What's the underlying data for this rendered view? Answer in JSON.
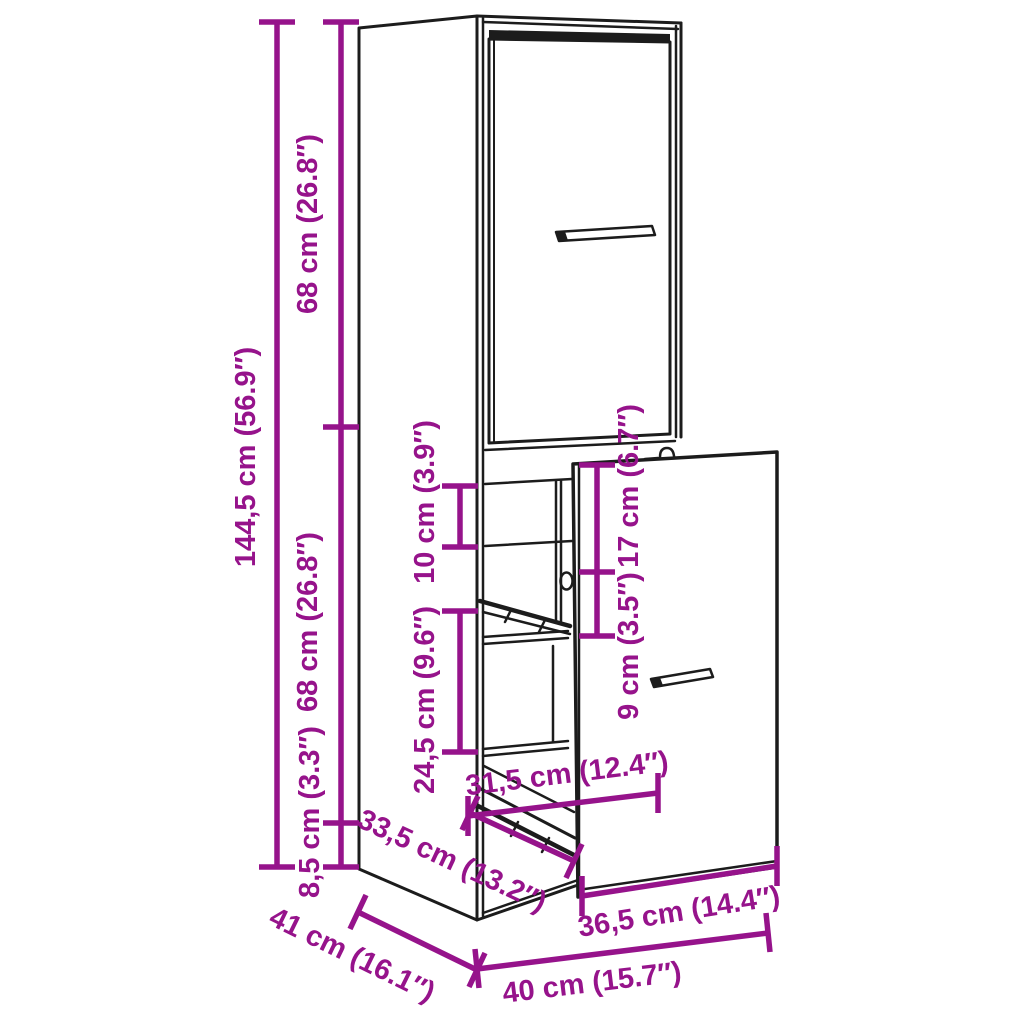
{
  "figure": {
    "title": "apothecary-cabinet-dimension-diagram",
    "colors": {
      "dimension_accent": "#96138b",
      "line_art": "#1c1c1c",
      "background": "#ffffff"
    }
  },
  "dims": {
    "total_height": "144,5 cm (56.9″)",
    "upper_section_height": "68 cm (26.8″)",
    "middle_section_height": "68 cm (26.8″)",
    "base_height": "8,5 cm (3.3″)",
    "top_gap": "10 cm (3.9″)",
    "middle_opening_height": "24,5 cm (9.6″)",
    "drawer_front_upper": "17 cm (6.7″)",
    "drawer_front_lower": "9 cm (3.5″)",
    "pullout_extension": "31,5 cm (12.4″)",
    "rail_length": "33,5 cm (13.2″)",
    "drawer_front_width": "36,5 cm (14.4″)",
    "depth": "41 cm (16.1″)",
    "width": "40 cm (15.7″)"
  }
}
